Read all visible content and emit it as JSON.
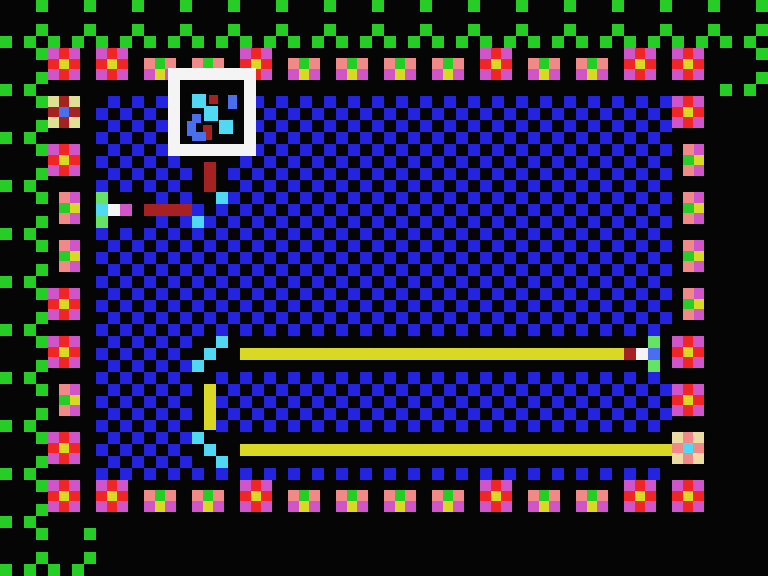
{
  "scene": {
    "width": 768,
    "height": 576,
    "background": "#050505"
  },
  "palette": {
    "K": "#050505",
    "G": "#25cd25",
    "B": "#2424e0",
    "M": "#d055c9",
    "R": "#f22525",
    "Y": "#d9d925",
    "S": "#f18989",
    "E": "#dfdf95",
    "P": "#ecdca4",
    "D": "#a62222",
    "U": "#4a6fee",
    "C": "#4fd9f2",
    "W": "#f4f4f4",
    "L": "#64e364"
  },
  "field": {
    "x": 96,
    "y": 96,
    "cols": 48,
    "rows": 32,
    "cell": 12,
    "blue": "#2424e0",
    "dark": "#050505"
  },
  "vine": {
    "color_code": "G",
    "dot_size": 12,
    "runs": [
      {
        "x": 36,
        "y": 0,
        "dx": 48,
        "dy": 0,
        "n": 16
      },
      {
        "x": 36,
        "y": 24,
        "dx": 48,
        "dy": 0,
        "n": 16
      },
      {
        "x": 0,
        "y": 36,
        "dx": 24,
        "dy": 0,
        "n": 32
      },
      {
        "x": 36,
        "y": 48,
        "dx": 720,
        "dy": 0,
        "n": 2
      },
      {
        "x": 756,
        "y": 72,
        "dx": 0,
        "dy": 0,
        "n": 1
      },
      {
        "x": 720,
        "y": 84,
        "dx": 24,
        "dy": 0,
        "n": 2
      },
      {
        "x": 36,
        "y": 72,
        "dx": 0,
        "dy": 24,
        "n": 19
      },
      {
        "x": 0,
        "y": 84,
        "dx": 0,
        "dy": 48,
        "n": 10
      },
      {
        "x": 24,
        "y": 84,
        "dx": 0,
        "dy": 48,
        "n": 10
      },
      {
        "x": 36,
        "y": 528,
        "dx": 48,
        "dy": 0,
        "n": 2
      },
      {
        "x": 36,
        "y": 552,
        "dx": 48,
        "dy": 0,
        "n": 2
      },
      {
        "x": 0,
        "y": 564,
        "dx": 24,
        "dy": 0,
        "n": 4
      }
    ]
  },
  "tile_defs": {
    "flower": {
      "w": 32,
      "h": 32,
      "dx": 0,
      "dy": 0,
      "cols": 3,
      "rows": 3,
      "grid": [
        "M",
        "R",
        "M",
        "R",
        "Y",
        "R",
        "M",
        "R",
        "M"
      ]
    },
    "bud": {
      "w": 32,
      "h": 22,
      "dx": 0,
      "dy": 10,
      "cols": 3,
      "rows": 2,
      "grid": [
        "S",
        "G",
        "S",
        "M",
        "Y",
        "M"
      ]
    },
    "bud_side": {
      "w": 21,
      "h": 32,
      "dx": 11,
      "dy": 0,
      "cols": 2,
      "rows": 3,
      "grid": [
        "S",
        "M",
        "G",
        "Y",
        "S",
        "M"
      ]
    },
    "berry_blue": {
      "w": 32,
      "h": 32,
      "dx": 0,
      "dy": 0,
      "cols": 3,
      "rows": 3,
      "grid": [
        "E",
        "D",
        "E",
        "D",
        "U",
        "D",
        "E",
        "D",
        "E"
      ]
    },
    "berry_cyan": {
      "w": 32,
      "h": 32,
      "dx": 0,
      "dy": 0,
      "cols": 3,
      "rows": 3,
      "grid": [
        "P",
        "S",
        "P",
        "S",
        "C",
        "S",
        "P",
        "S",
        "P"
      ]
    }
  },
  "border_tiles": [
    {
      "type": "flower",
      "x": 48,
      "y": 48
    },
    {
      "type": "flower",
      "x": 96,
      "y": 48
    },
    {
      "type": "bud",
      "x": 144,
      "y": 48
    },
    {
      "type": "bud",
      "x": 192,
      "y": 48
    },
    {
      "type": "flower",
      "x": 240,
      "y": 48
    },
    {
      "type": "bud",
      "x": 288,
      "y": 48
    },
    {
      "type": "bud",
      "x": 336,
      "y": 48
    },
    {
      "type": "bud",
      "x": 384,
      "y": 48
    },
    {
      "type": "bud",
      "x": 432,
      "y": 48
    },
    {
      "type": "flower",
      "x": 480,
      "y": 48
    },
    {
      "type": "bud",
      "x": 528,
      "y": 48
    },
    {
      "type": "bud",
      "x": 576,
      "y": 48
    },
    {
      "type": "flower",
      "x": 624,
      "y": 48
    },
    {
      "type": "flower",
      "x": 672,
      "y": 48
    },
    {
      "type": "flower",
      "x": 48,
      "y": 480
    },
    {
      "type": "flower",
      "x": 96,
      "y": 480
    },
    {
      "type": "bud",
      "x": 144,
      "y": 480
    },
    {
      "type": "bud",
      "x": 192,
      "y": 480
    },
    {
      "type": "flower",
      "x": 240,
      "y": 480
    },
    {
      "type": "bud",
      "x": 288,
      "y": 480
    },
    {
      "type": "bud",
      "x": 336,
      "y": 480
    },
    {
      "type": "bud",
      "x": 384,
      "y": 480
    },
    {
      "type": "bud",
      "x": 432,
      "y": 480
    },
    {
      "type": "flower",
      "x": 480,
      "y": 480
    },
    {
      "type": "bud",
      "x": 528,
      "y": 480
    },
    {
      "type": "bud",
      "x": 576,
      "y": 480
    },
    {
      "type": "flower",
      "x": 624,
      "y": 480
    },
    {
      "type": "flower",
      "x": 672,
      "y": 480
    },
    {
      "type": "berry_blue",
      "x": 48,
      "y": 96
    },
    {
      "type": "flower",
      "x": 48,
      "y": 144
    },
    {
      "type": "bud_side",
      "x": 48,
      "y": 192
    },
    {
      "type": "bud_side",
      "x": 48,
      "y": 240
    },
    {
      "type": "flower",
      "x": 48,
      "y": 288
    },
    {
      "type": "flower",
      "x": 48,
      "y": 336
    },
    {
      "type": "bud_side",
      "x": 48,
      "y": 384
    },
    {
      "type": "flower",
      "x": 48,
      "y": 432
    },
    {
      "type": "flower",
      "x": 672,
      "y": 96
    },
    {
      "type": "bud_side",
      "x": 672,
      "y": 144
    },
    {
      "type": "bud_side",
      "x": 672,
      "y": 192
    },
    {
      "type": "bud_side",
      "x": 672,
      "y": 240
    },
    {
      "type": "bud_side",
      "x": 672,
      "y": 288
    },
    {
      "type": "flower",
      "x": 672,
      "y": 336
    },
    {
      "type": "flower",
      "x": 672,
      "y": 384
    },
    {
      "type": "berry_cyan",
      "x": 672,
      "y": 432
    }
  ],
  "clearings": [
    {
      "x": 192,
      "y": 336,
      "w": 480,
      "h": 36
    },
    {
      "x": 192,
      "y": 372,
      "w": 24,
      "h": 60
    },
    {
      "x": 192,
      "y": 432,
      "w": 480,
      "h": 36
    },
    {
      "x": 96,
      "y": 192,
      "w": 48,
      "h": 36
    },
    {
      "x": 192,
      "y": 156,
      "w": 36,
      "h": 48
    }
  ],
  "items": [
    {
      "name": "yellow-bar-1",
      "x": 240,
      "y": 348,
      "w": 384,
      "h": 12,
      "c": "Y"
    },
    {
      "name": "bar1-head-darkred",
      "x": 624,
      "y": 348,
      "w": 12,
      "h": 12,
      "c": "D"
    },
    {
      "name": "bar1-head-white",
      "x": 636,
      "y": 348,
      "w": 12,
      "h": 12,
      "c": "W"
    },
    {
      "name": "bar1-head-blue",
      "x": 648,
      "y": 348,
      "w": 12,
      "h": 12,
      "c": "U"
    },
    {
      "name": "bar1-head-leaf-top",
      "x": 648,
      "y": 336,
      "w": 12,
      "h": 12,
      "c": "L"
    },
    {
      "name": "bar1-head-leaf-bottom",
      "x": 648,
      "y": 360,
      "w": 12,
      "h": 12,
      "c": "L"
    },
    {
      "name": "yellow-bar-vertical",
      "x": 204,
      "y": 384,
      "w": 12,
      "h": 46,
      "c": "Y"
    },
    {
      "name": "yellow-bar-2",
      "x": 240,
      "y": 444,
      "w": 432,
      "h": 12,
      "c": "Y"
    },
    {
      "name": "cyan-step",
      "x": 216,
      "y": 336,
      "w": 12,
      "h": 12,
      "c": "C"
    },
    {
      "name": "cyan-step",
      "x": 204,
      "y": 348,
      "w": 12,
      "h": 12,
      "c": "C"
    },
    {
      "name": "cyan-step",
      "x": 192,
      "y": 360,
      "w": 12,
      "h": 12,
      "c": "C"
    },
    {
      "name": "cyan-step",
      "x": 192,
      "y": 432,
      "w": 12,
      "h": 12,
      "c": "C"
    },
    {
      "name": "cyan-step",
      "x": 204,
      "y": 444,
      "w": 12,
      "h": 12,
      "c": "C"
    },
    {
      "name": "cyan-step",
      "x": 216,
      "y": 456,
      "w": 12,
      "h": 12,
      "c": "C"
    },
    {
      "name": "cyan-step",
      "x": 216,
      "y": 192,
      "w": 12,
      "h": 12,
      "c": "C"
    },
    {
      "name": "cyan-step",
      "x": 192,
      "y": 216,
      "w": 12,
      "h": 12,
      "c": "C"
    },
    {
      "name": "worm-body-vertical",
      "x": 204,
      "y": 162,
      "w": 12,
      "h": 30,
      "c": "D"
    },
    {
      "name": "worm-body-horizontal",
      "x": 144,
      "y": 204,
      "w": 48,
      "h": 12,
      "c": "D"
    },
    {
      "name": "worm-head-leaf-top",
      "x": 96,
      "y": 192,
      "w": 12,
      "h": 12,
      "c": "L"
    },
    {
      "name": "worm-head-cyan",
      "x": 96,
      "y": 204,
      "w": 12,
      "h": 12,
      "c": "C"
    },
    {
      "name": "worm-head-white",
      "x": 108,
      "y": 204,
      "w": 12,
      "h": 12,
      "c": "W"
    },
    {
      "name": "worm-head-magenta",
      "x": 120,
      "y": 204,
      "w": 12,
      "h": 12,
      "c": "M"
    },
    {
      "name": "worm-head-leaf-bottom",
      "x": 96,
      "y": 216,
      "w": 12,
      "h": 12,
      "c": "L"
    }
  ],
  "item_box": {
    "x": 168,
    "y": 68,
    "w": 88,
    "h": 88,
    "frame_thickness": 12,
    "frame_color_code": "W",
    "inner_color_code": "K",
    "icon_pixels": [
      {
        "x": 24,
        "y": 26,
        "w": 14,
        "h": 14,
        "c": "C"
      },
      {
        "x": 41,
        "y": 27,
        "w": 9,
        "h": 9,
        "c": "D"
      },
      {
        "x": 60,
        "y": 27,
        "w": 9,
        "h": 14,
        "c": "U"
      },
      {
        "x": 36,
        "y": 38,
        "w": 14,
        "h": 15,
        "c": "C"
      },
      {
        "x": 24,
        "y": 46,
        "w": 9,
        "h": 9,
        "c": "U"
      },
      {
        "x": 19,
        "y": 53,
        "w": 9,
        "h": 15,
        "c": "U"
      },
      {
        "x": 35,
        "y": 57,
        "w": 9,
        "h": 15,
        "c": "D"
      },
      {
        "x": 51,
        "y": 52,
        "w": 14,
        "h": 14,
        "c": "C"
      },
      {
        "x": 24,
        "y": 64,
        "w": 14,
        "h": 9,
        "c": "U"
      }
    ]
  }
}
